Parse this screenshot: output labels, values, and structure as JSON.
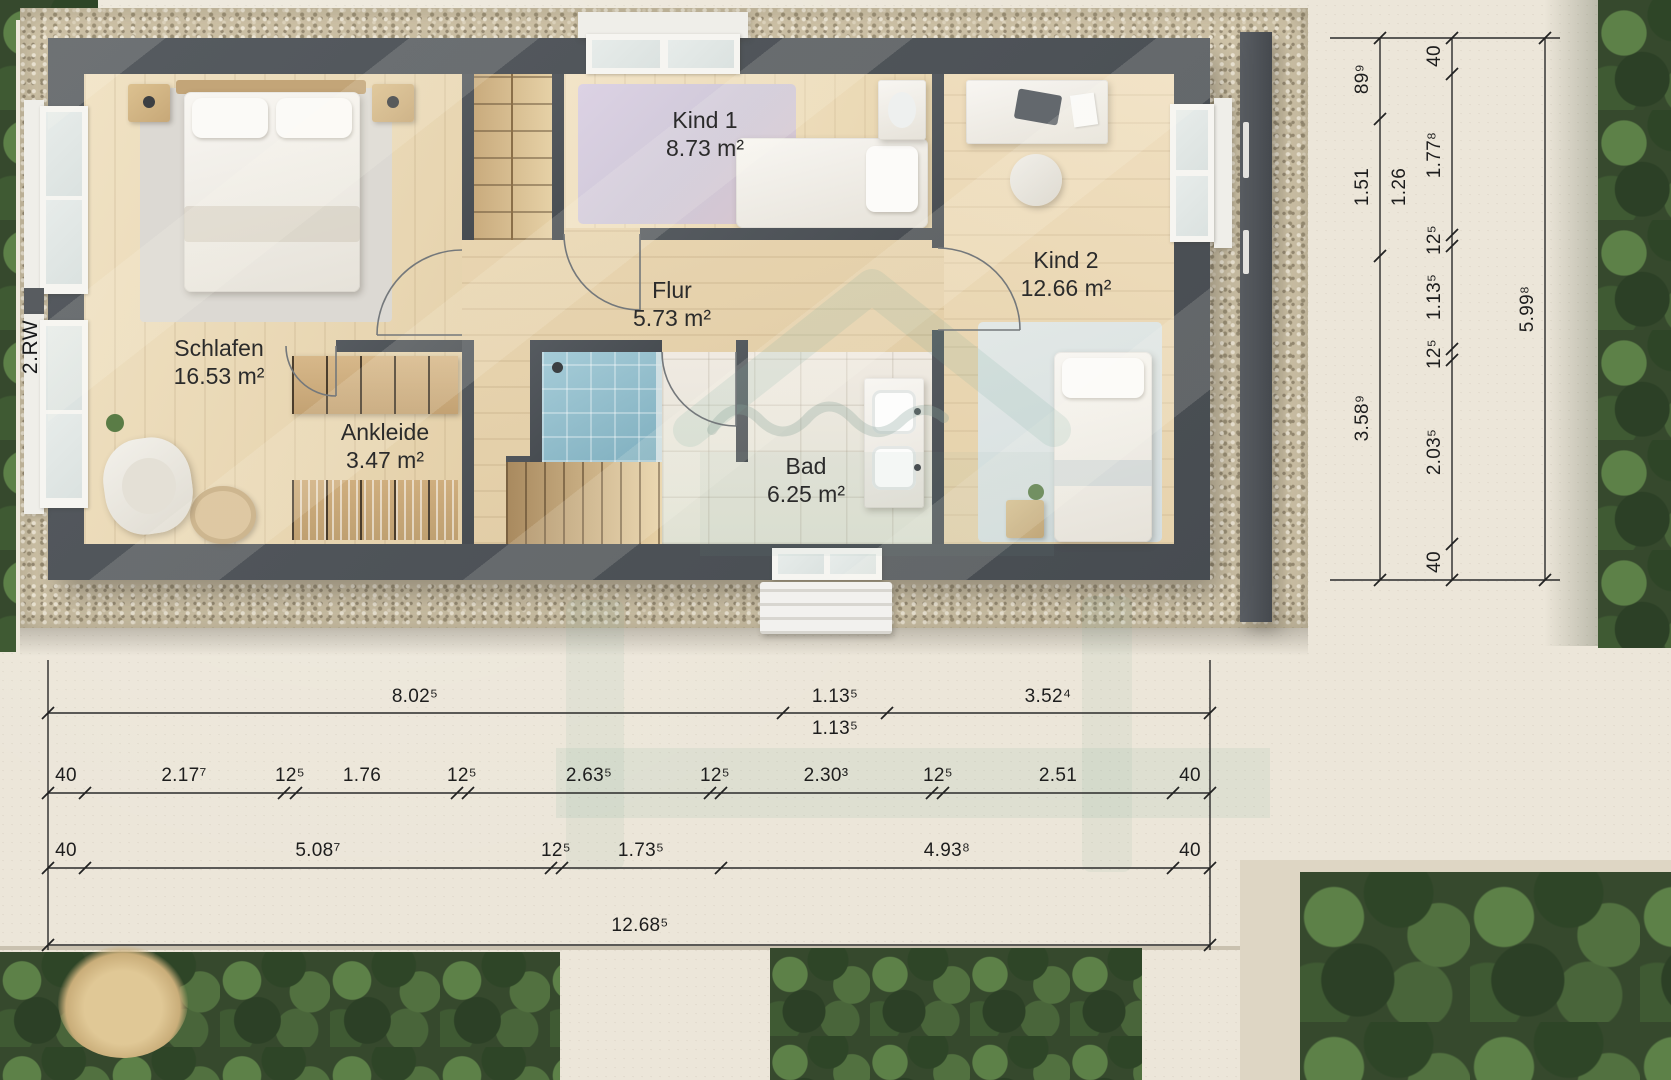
{
  "scene": {
    "level_label": "2.RW"
  },
  "rooms": {
    "schlafen": {
      "name": "Schlafen",
      "area": "16.53 m²"
    },
    "ankleide": {
      "name": "Ankleide",
      "area": "3.47 m²"
    },
    "flur": {
      "name": "Flur",
      "area": "5.73 m²"
    },
    "kind1": {
      "name": "Kind 1",
      "area": "8.73 m²"
    },
    "kind2": {
      "name": "Kind 2",
      "area": "12.66 m²"
    },
    "bad": {
      "name": "Bad",
      "area": "6.25 m²"
    }
  },
  "dims": {
    "bottom": {
      "row1": [
        "8.02⁵",
        "1.13⁵",
        "3.52⁴"
      ],
      "row1_sub": "1.13⁵",
      "row2": [
        "40",
        "2.17⁷",
        "12⁵",
        "1.76",
        "12⁵",
        "2.63⁵",
        "12⁵",
        "2.30³",
        "12⁵",
        "2.51",
        "40"
      ],
      "row3": [
        "40",
        "5.08⁷",
        "12⁵",
        "1.73⁵",
        "4.93⁸",
        "40"
      ],
      "total": "12.68⁵"
    },
    "right": {
      "inner": [
        "89⁹",
        "1.51",
        "3.58⁹"
      ],
      "inner_extra": "1.26",
      "outer": [
        "40",
        "1.77⁸",
        "12⁵",
        "1.13⁵",
        "12⁵",
        "2.03⁵",
        "40"
      ],
      "total": "5.99⁸"
    }
  },
  "colors": {
    "wall": "#4d5157",
    "gravel": "#d2c6aa",
    "pavement": "#ece6d9",
    "wood": "#e9d8b8",
    "shower_tile": "#8cbccb",
    "hedge": "#36492d",
    "watermark": "#74a79b",
    "dim_text": "#1d1d1d"
  }
}
